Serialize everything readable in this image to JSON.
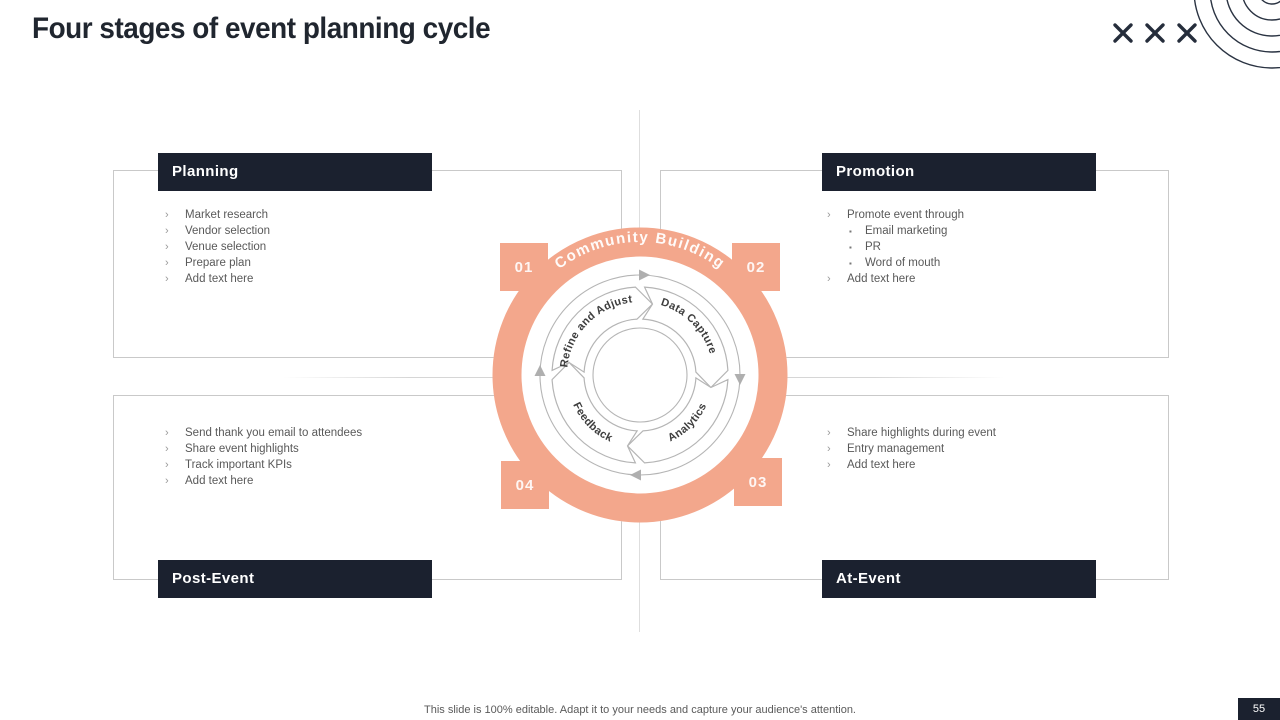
{
  "slide": {
    "title": "Four stages of event planning cycle",
    "footer": "This slide is 100% editable. Adapt it to your needs and capture your audience's attention.",
    "page_number": "55"
  },
  "colors": {
    "accent_salmon": "#f3a78c",
    "dark_navy": "#1b212f",
    "line_gray": "#b5b5b5"
  },
  "glyphs": {
    "bullet": "›",
    "sub_bullet": "▪",
    "x_mark": "close-x-decoration"
  },
  "cycle": {
    "center_label": "Community Building",
    "segments": [
      "Refine and Adjust",
      "Data Capture",
      "Analytics",
      "Feedback"
    ],
    "badges": [
      "01",
      "02",
      "03",
      "04"
    ]
  },
  "quadrants": [
    {
      "title": "Planning",
      "badge": "01",
      "rows": [
        {
          "level": 1,
          "text": "Market research"
        },
        {
          "level": 1,
          "text": "Vendor selection"
        },
        {
          "level": 1,
          "text": "Venue selection"
        },
        {
          "level": 1,
          "text": "Prepare  plan"
        },
        {
          "level": 1,
          "text": "Add text here"
        }
      ]
    },
    {
      "title": "Promotion",
      "badge": "02",
      "rows": [
        {
          "level": 1,
          "text": "Promote event through"
        },
        {
          "level": 2,
          "text": "Email marketing"
        },
        {
          "level": 2,
          "text": "PR"
        },
        {
          "level": 2,
          "text": "Word of mouth"
        },
        {
          "level": 1,
          "text": "Add text here"
        }
      ]
    },
    {
      "title": "At-Event",
      "badge": "03",
      "rows": [
        {
          "level": 1,
          "text": "Share highlights during event"
        },
        {
          "level": 1,
          "text": "Entry management"
        },
        {
          "level": 1,
          "text": "Add text here"
        }
      ]
    },
    {
      "title": "Post-Event",
      "badge": "04",
      "rows": [
        {
          "level": 1,
          "text": "Send thank you email to attendees"
        },
        {
          "level": 1,
          "text": "Share event highlights"
        },
        {
          "level": 1,
          "text": "Track important KPIs"
        },
        {
          "level": 1,
          "text": "Add text here"
        }
      ]
    }
  ]
}
